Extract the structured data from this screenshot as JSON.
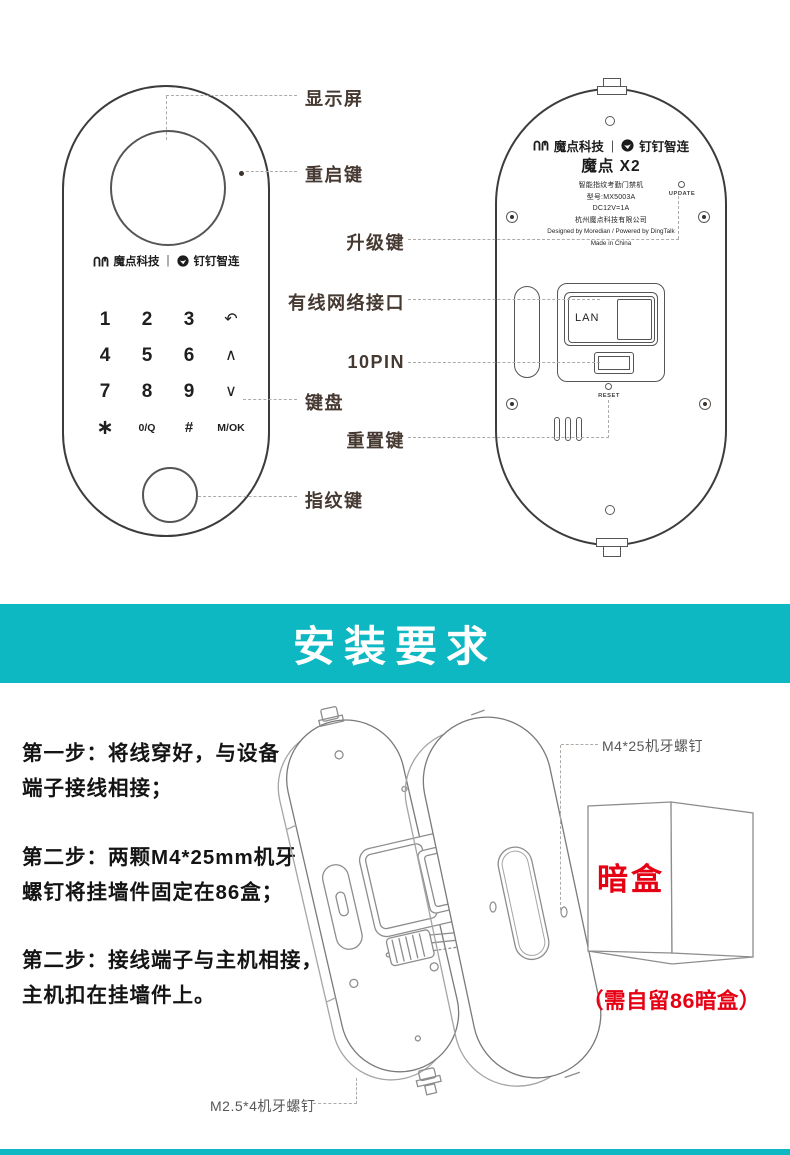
{
  "colors": {
    "teal": "#0db8c3",
    "red": "#e60013",
    "callout_text": "#453931",
    "line_art": "#3c3c3c"
  },
  "brand": {
    "moredian": "魔点科技",
    "sep": "|",
    "dingtalk": "钉钉智连"
  },
  "front_device": {
    "keypad": [
      "1",
      "2",
      "3",
      "↶",
      "4",
      "5",
      "6",
      "∧",
      "7",
      "8",
      "9",
      "∨",
      "∗",
      "0/Q",
      "#",
      "M/OK"
    ],
    "callouts": {
      "display": "显示屏",
      "restart": "重启键",
      "keyboard": "键盘",
      "fingerprint": "指纹键"
    }
  },
  "back_device": {
    "model_title": "魔点 X2",
    "info": [
      "智能指纹考勤门禁机",
      "型号:MX5003A",
      "DC12V=1A",
      "杭州魔点科技有限公司",
      "Designed by Moredian / Powered by DingTalk",
      "Made in China"
    ],
    "update_label": "UPDATE",
    "lan_label": "LAN",
    "reset_label": "RESET",
    "callouts": {
      "upgrade": "升级键",
      "ethernet": "有线网络接口",
      "pin10": "10PIN",
      "reset": "重置键"
    }
  },
  "banner": {
    "title": "安装要求"
  },
  "install": {
    "steps": [
      {
        "line1": "第一步：将线穿好，与设备",
        "line2": "端子接线相接；"
      },
      {
        "line1": "第二步：两颗M4*25mm机牙",
        "line2": "螺钉将挂墙件固定在86盒；"
      },
      {
        "line1": "第二步：接线端子与主机相接，",
        "line2": "主机扣在挂墙件上。"
      }
    ],
    "labels": {
      "screw_m4": "M4*25机牙螺钉",
      "screw_m25": "M2.5*4机牙螺钉",
      "junction_box": "暗盒",
      "junction_note": "（需自留86暗盒）"
    }
  },
  "icons": {
    "moredian_logo": "hm-arches",
    "dingtalk_logo": "wing-in-circle"
  }
}
